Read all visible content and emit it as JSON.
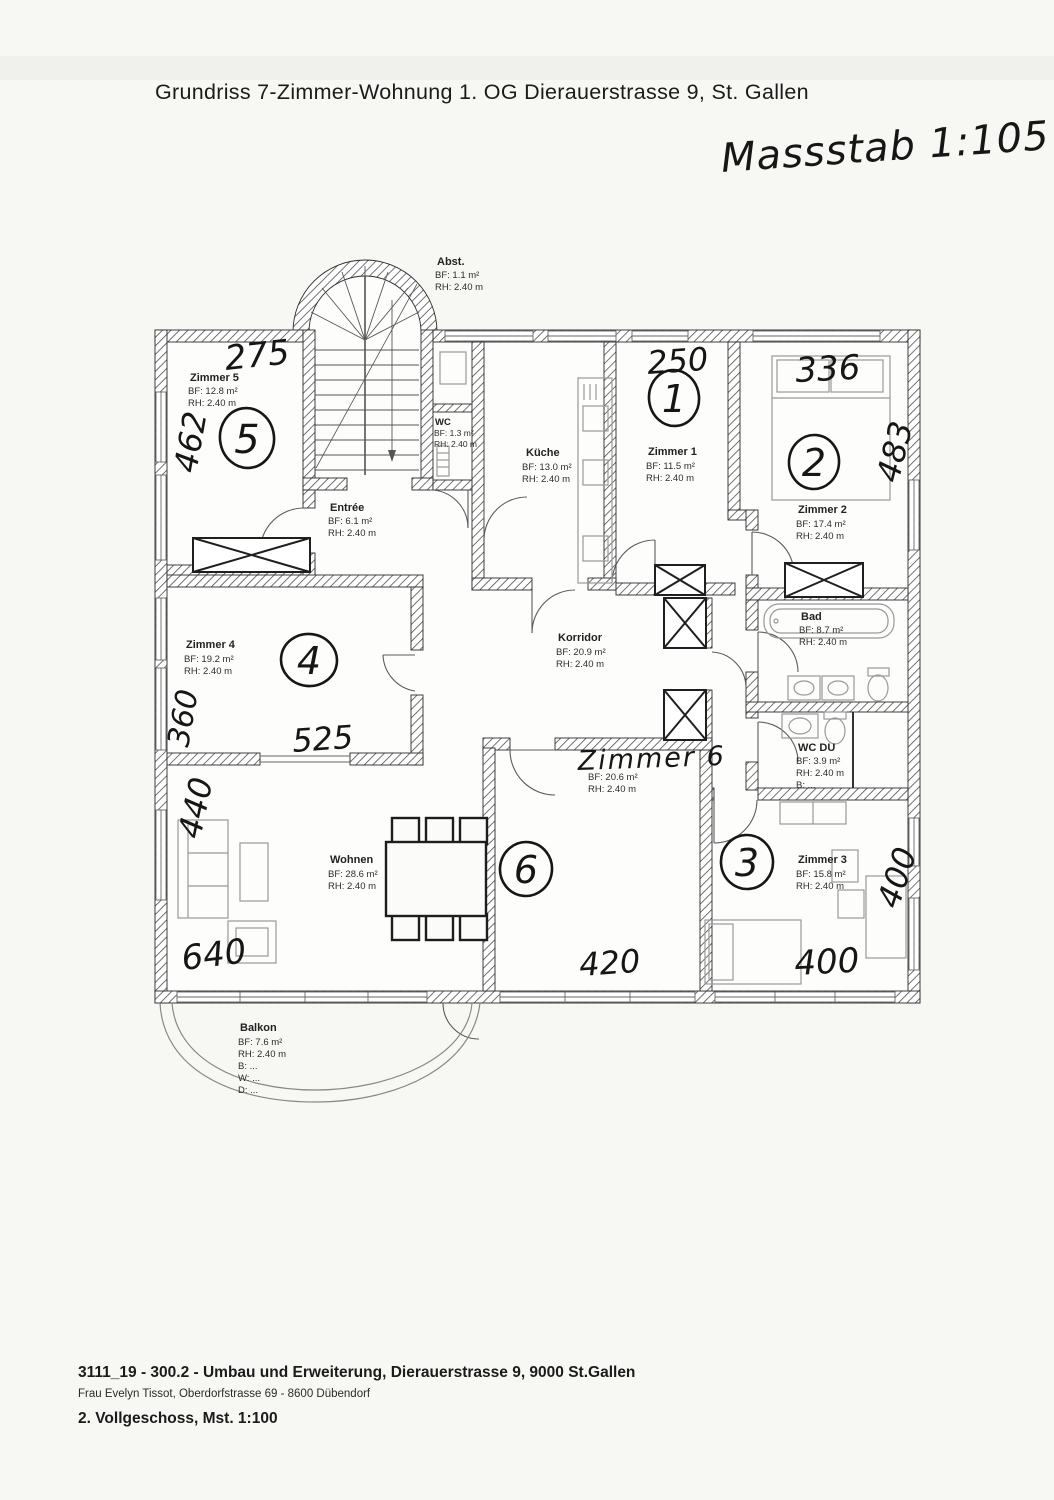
{
  "page": {
    "title": "Grundriss 7-Zimmer-Wohnung 1. OG  Dierauerstrasse 9, St. Gallen",
    "scale_note": "Massstab 1:105"
  },
  "rooms": {
    "zimmer5": {
      "name": "Zimmer 5",
      "bf": "BF: 12.8 m²",
      "rh": "RH: 2.40 m"
    },
    "abst": {
      "name": "Abst.",
      "bf": "BF: 1.1 m²",
      "rh": "RH: 2.40 m"
    },
    "wc": {
      "name": "WC",
      "bf": "BF: 1.3 m²",
      "rh": "RH: 2.40 m"
    },
    "entree": {
      "name": "Entrée",
      "bf": "BF: 6.1 m²",
      "rh": "RH: 2.40 m"
    },
    "kueche": {
      "name": "Küche",
      "bf": "BF: 13.0 m²",
      "rh": "RH: 2.40 m"
    },
    "zimmer1": {
      "name": "Zimmer 1",
      "bf": "BF: 11.5 m²",
      "rh": "RH: 2.40 m"
    },
    "zimmer2": {
      "name": "Zimmer 2",
      "bf": "BF: 17.4 m²",
      "rh": "RH: 2.40 m"
    },
    "bad": {
      "name": "Bad",
      "bf": "BF: 8.7 m²",
      "rh": "RH: 2.40 m"
    },
    "wcdu": {
      "name": "WC DU",
      "bf": "BF: 3.9 m²",
      "rh": "RH: 2.40 m",
      "b": "B: ..."
    },
    "korridor": {
      "name": "Korridor",
      "bf": "BF: 20.9 m²",
      "rh": "RH: 2.40 m"
    },
    "zimmer4": {
      "name": "Zimmer 4",
      "bf": "BF: 19.2 m²",
      "rh": "RH: 2.40 m"
    },
    "wohnen": {
      "name": "Wohnen",
      "bf": "BF: 28.6 m²",
      "rh": "RH: 2.40 m"
    },
    "zimmer6": {
      "name": "Zimmer 6",
      "bf": "BF: 20.6 m²",
      "rh": "RH: 2.40 m"
    },
    "zimmer3": {
      "name": "Zimmer 3",
      "bf": "BF: 15.8 m²",
      "rh": "RH: 2.40 m"
    },
    "balkon": {
      "name": "Balkon",
      "bf": "BF: 7.6 m²",
      "rh": "RH: 2.40 m",
      "b": "B: ...",
      "w": "W: ...",
      "d": "D: ..."
    }
  },
  "handwritten": {
    "room_numbers": {
      "n1": "1",
      "n2": "2",
      "n3": "3",
      "n4": "4",
      "n5": "5",
      "n6": "6"
    },
    "zimmer6_name": "Zimmer 6",
    "dimensions": {
      "zimmer5_top": "275",
      "zimmer5_left": "462",
      "zimmer1_top": "250",
      "zimmer2_top": "336",
      "zimmer2_right": "483",
      "zimmer4_left": "360",
      "zimmer4_bottom": "525",
      "wohnen_left": "440",
      "wohnen_bottom": "640",
      "zimmer6_bottom": "420",
      "zimmer3_right": "400",
      "zimmer3_bottom": "400"
    }
  },
  "footer": {
    "line1": "3111_19 - 300.2 - Umbau und Erweiterung, Dierauerstrasse 9, 9000 St.Gallen",
    "line2": "Frau Evelyn Tissot, Oberdorfstrasse 69 - 8600 Dübendorf",
    "line3": "2. Vollgeschoss, Mst. 1:100"
  },
  "colors": {
    "paper": "#f7f7f4",
    "ink": "#1c1c1c",
    "print": "#262626"
  }
}
